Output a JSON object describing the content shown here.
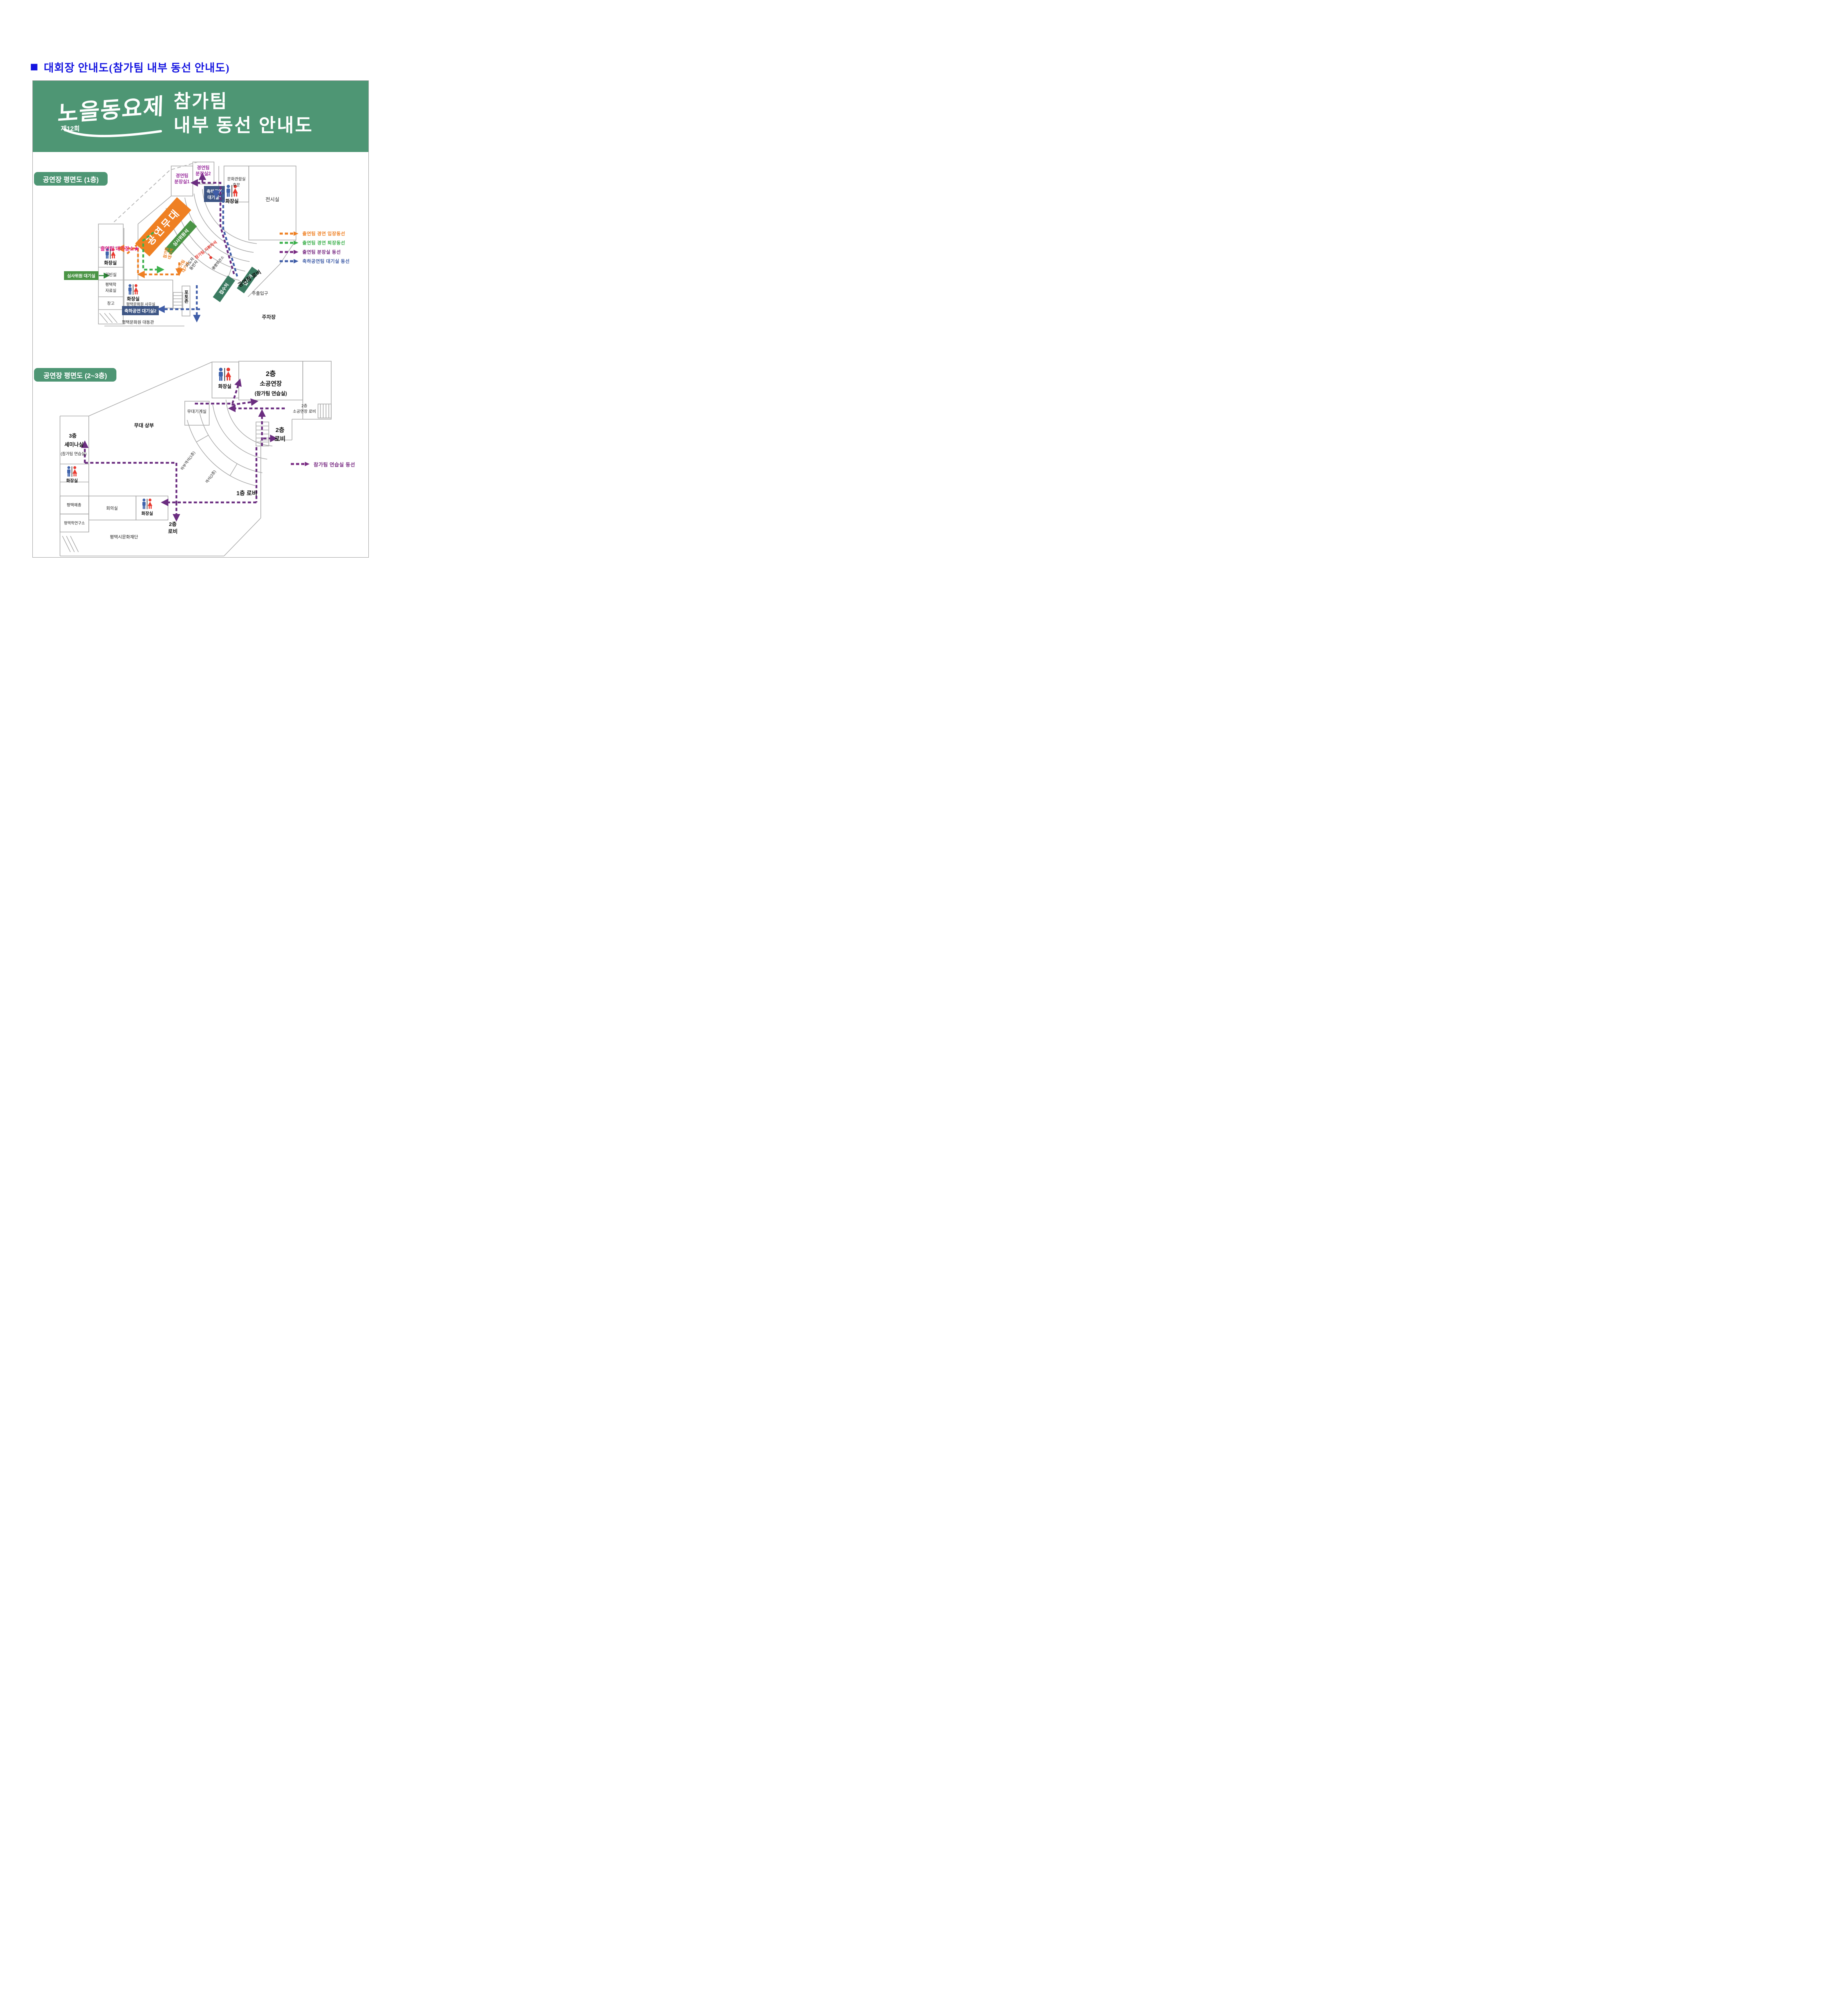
{
  "header": {
    "bullet": "■",
    "title": "대회장 안내도(참가팀 내부 동선 안내도)"
  },
  "banner": {
    "logo": "노을동요제",
    "edition": "제12회",
    "line1": "참가팀",
    "line2": "내부 동선 안내도"
  },
  "colors": {
    "title_blue": "#1515e0",
    "banner_green": "#4e9674",
    "route_orange": "#ef8023",
    "route_green": "#3cb04c",
    "route_purple": "#6b2d80",
    "route_blue": "#3f5da8",
    "box_navy": "#3d5584",
    "box_green": "#4a9445",
    "box_teal": "#3a7a60",
    "label_purple": "#9c34a0",
    "magenta": "#e0218a",
    "red": "#e8392f",
    "wall_gray": "#ababab"
  },
  "plan1": {
    "section_label": "공연장 평면도 (1층)",
    "rooms": {
      "dressing1": {
        "l1": "경연팀",
        "l2": "분장실1"
      },
      "dressing2": {
        "l1": "경연팀",
        "l2": "분장실2"
      },
      "culture": {
        "l1": "문화관람실",
        "l2": "후문"
      },
      "exhibition": "전시실",
      "celeb1": {
        "l1": "축하공연",
        "l2": "대기실1"
      },
      "toilet_top": "화장실",
      "stage": "공연무대",
      "judges": "심사위원석",
      "waiting_area": "출연팀 대기장소★",
      "team_seat1": {
        "l1": "참가팀",
        "l2": "대기석"
      },
      "team_seat2": {
        "l1": "참가팀",
        "l2": "대기석"
      },
      "conductor": "참가팀 지휘자석",
      "leader": {
        "l1": "지도자",
        "l2": "동반자"
      },
      "storage": "물품보관소",
      "lobby": "공연장 로비",
      "reception1": "접수처",
      "reception2": "접수처",
      "entrance": "주출입구",
      "parking": "주차장",
      "photozone": "포토존",
      "toilet_left": "화장실",
      "judge_wait": "심사위원 대기실",
      "vip": "귀빈실",
      "archive": {
        "l1": "평택학",
        "l2": "자료실"
      },
      "warehouse": "창고",
      "toilet_center": "화장실",
      "office": "평택문화원 사무실",
      "celeb2": "축하공연 대기실2",
      "hall": "평택문화원 대동관"
    },
    "legend": [
      {
        "label": "출연팀 경연 입장동선",
        "color": "#ef8023"
      },
      {
        "label": "출연팀 경연 퇴장동선",
        "color": "#3cb04c"
      },
      {
        "label": "출연팀 분장실 동선",
        "color": "#7a2d84"
      },
      {
        "label": "축하공연팀 대기실 동선",
        "color": "#3f5da8"
      }
    ]
  },
  "plan2": {
    "section_label": "공연장 평면도 (2~3층)",
    "rooms": {
      "toilet_top": "화장실",
      "small_hall": {
        "l1": "2층",
        "l2": "소공연장",
        "l3": "(참가팀 연습실)"
      },
      "small_lobby": {
        "l1": "2층",
        "l2": "소공연장 로비"
      },
      "machine": "무대기계실",
      "stage_upper": "무대 상부",
      "lobby2": {
        "l1": "2층",
        "l2": "로비"
      },
      "seminar": {
        "l1": "3층",
        "l2": "세미나실",
        "l3": "(참가팀 연습실)"
      },
      "toilet_left": "화장실",
      "arts": "평택예총",
      "meeting": "회의실",
      "toilet_bottom": "화장실",
      "institute": "평택학연구소",
      "lower_seats": "하부객석(1층)",
      "seats2": "객석(2층)",
      "lobby1": "1층 로비",
      "lobby2b": {
        "l1": "2층",
        "l2": "로비"
      },
      "foundation": "평택시문화재단"
    },
    "legend": [
      {
        "label": "참가팀 연습실 동선",
        "color": "#7a2d84"
      }
    ]
  }
}
